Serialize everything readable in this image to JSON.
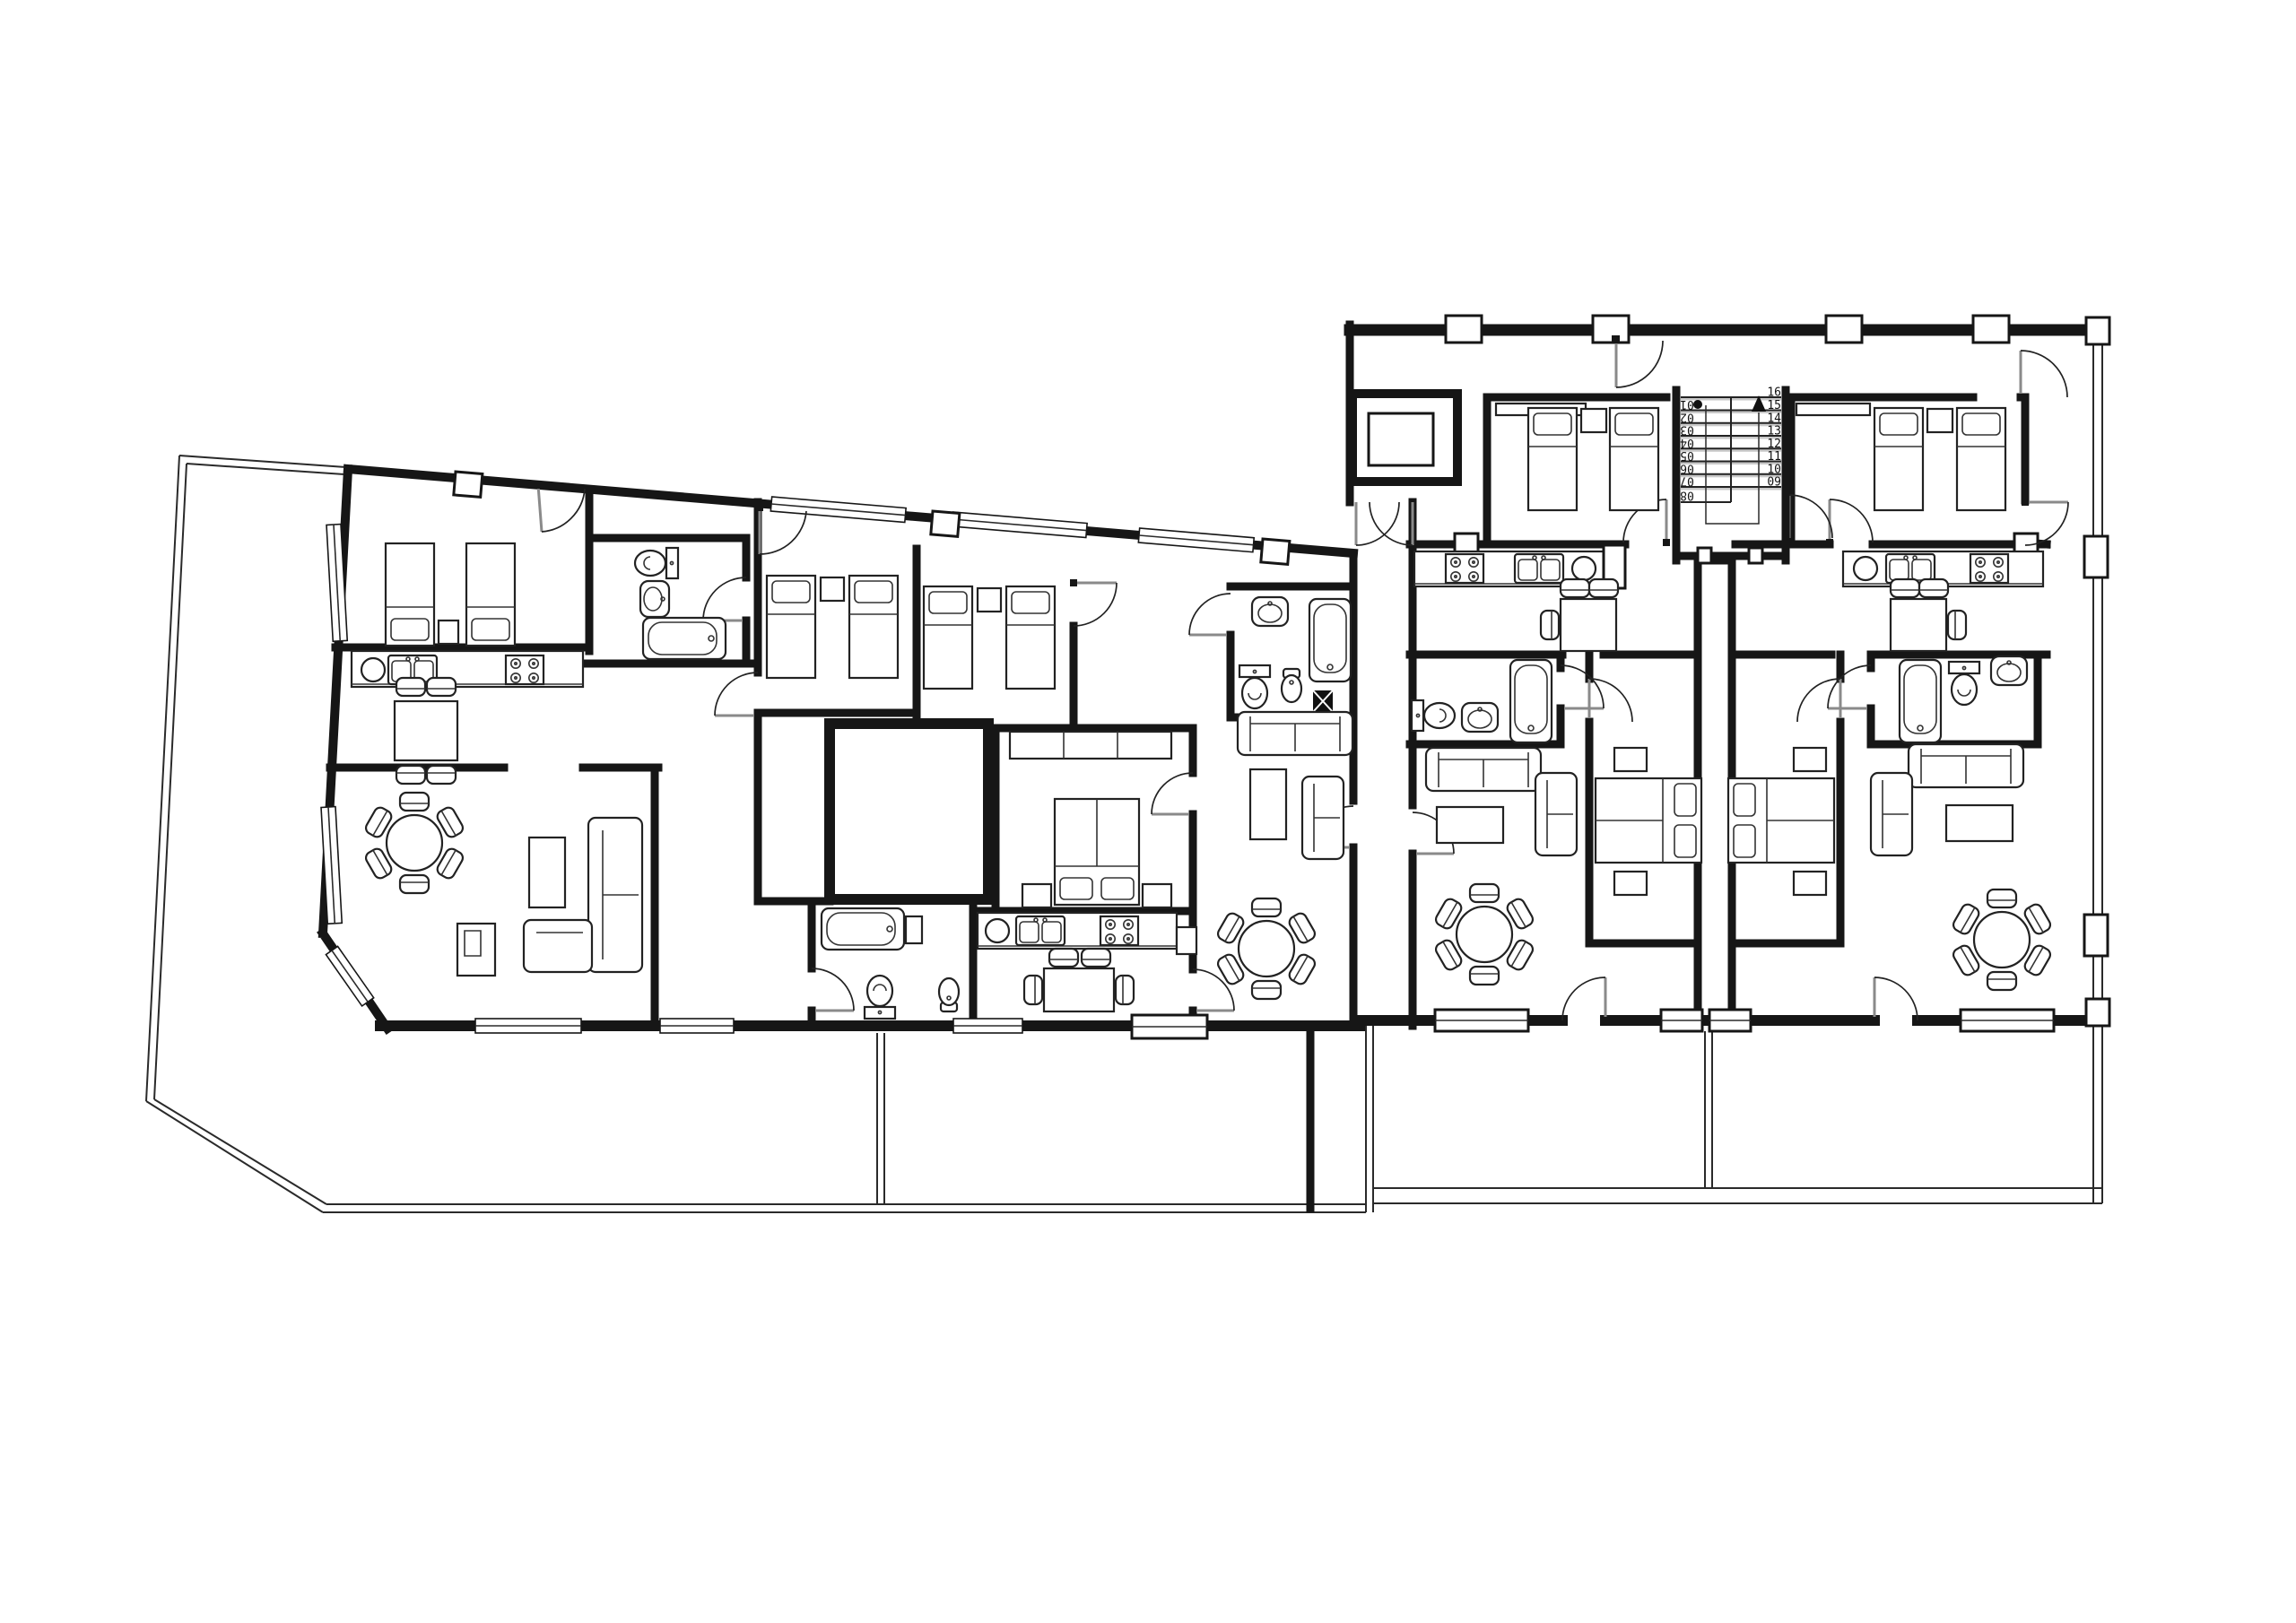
{
  "page": {
    "title": "Apartment building floor plan",
    "background_color": "#ffffff",
    "line_color": "#161616"
  },
  "staircase": {
    "left_flight_steps": [
      "01",
      "02",
      "03",
      "04",
      "05",
      "06",
      "07",
      "08"
    ],
    "right_flight_steps": [
      "16",
      "15",
      "14",
      "13",
      "12",
      "11",
      "10",
      "09"
    ],
    "start_marker": "dot",
    "direction_marker": "up-arrow"
  }
}
